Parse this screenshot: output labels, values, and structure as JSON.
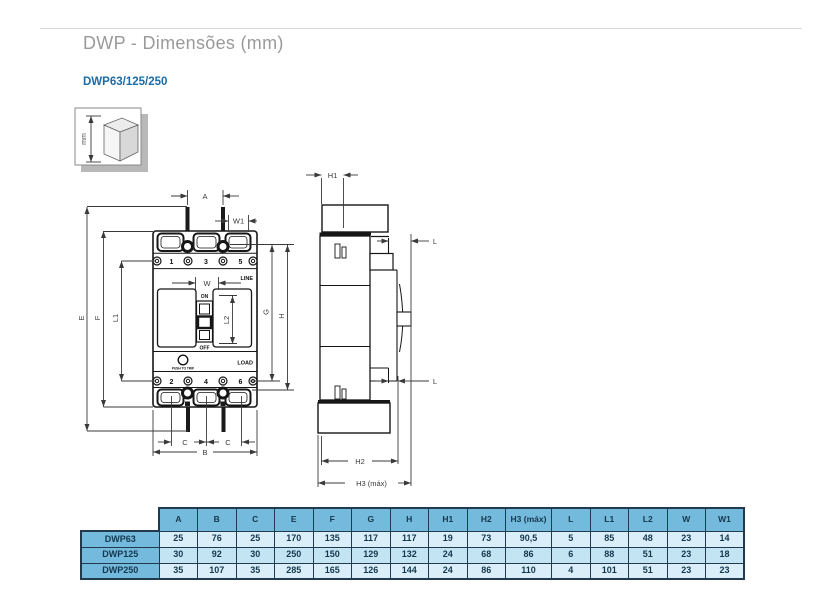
{
  "header": {
    "title": "DWP - Dimensões (mm)",
    "model_line": "DWP63/125/250"
  },
  "diagram": {
    "unit_label": "mm",
    "front_view": {
      "poles_top": [
        "1",
        "3",
        "5"
      ],
      "poles_bottom": [
        "2",
        "4",
        "6"
      ],
      "line_label": "LINE",
      "load_label": "LOAD",
      "on_label": "ON",
      "off_label": "OFF",
      "trip_label": "PUSH TO TRIP",
      "dims": {
        "a": "A",
        "w1": "W1",
        "w": "W",
        "l2": "L2",
        "e": "E",
        "f": "F",
        "l1": "L1",
        "g": "G",
        "h": "H",
        "c_left": "C",
        "c_right": "C",
        "b": "B"
      }
    },
    "side_view": {
      "dims": {
        "h1": "H1",
        "l_top": "L",
        "l_bottom": "L",
        "h2": "H2",
        "h3": "H3 (máx)"
      }
    }
  },
  "table": {
    "columns": [
      "",
      "A",
      "B",
      "C",
      "E",
      "F",
      "G",
      "H",
      "H1",
      "H2",
      "H3 (máx)",
      "L",
      "L1",
      "L2",
      "W",
      "W1"
    ],
    "rows": [
      {
        "label": "DWP63",
        "values": [
          "25",
          "76",
          "25",
          "170",
          "135",
          "117",
          "117",
          "19",
          "73",
          "90,5",
          "5",
          "85",
          "48",
          "23",
          "14"
        ]
      },
      {
        "label": "DWP125",
        "values": [
          "30",
          "92",
          "30",
          "250",
          "150",
          "129",
          "132",
          "24",
          "68",
          "86",
          "6",
          "88",
          "51",
          "23",
          "18"
        ]
      },
      {
        "label": "DWP250",
        "values": [
          "35",
          "107",
          "35",
          "285",
          "165",
          "126",
          "144",
          "24",
          "86",
          "110",
          "4",
          "101",
          "51",
          "23",
          "23"
        ]
      }
    ]
  },
  "colors": {
    "accent_blue": "#1b6ca8",
    "table_header_blue": "#74badd",
    "row_light": "#d9eef9",
    "row_medium": "#c3e4f3",
    "table_border": "#223a4e",
    "title_gray": "#9a9a9c"
  }
}
